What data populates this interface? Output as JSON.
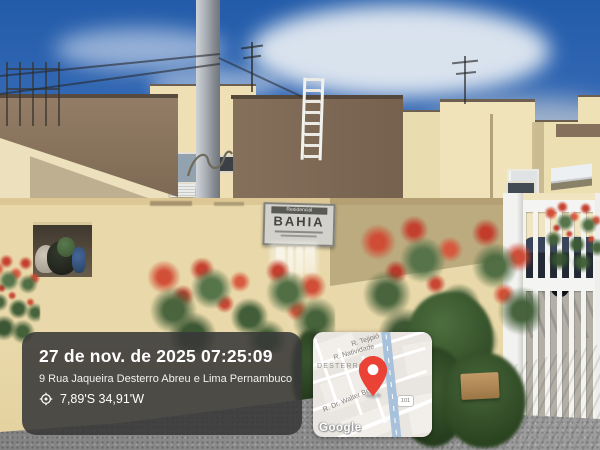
{
  "photo_overlay": {
    "timestamp": "27 de nov. de 2025 07:25:09",
    "address": "9 Rua Jaqueira Desterro Abreu e Lima Pernambuco",
    "coordinates": "7,89'S 34,91'W",
    "location_icon": "target-circle-icon",
    "panel_color": "#3a3a3a"
  },
  "map_card": {
    "streets": {
      "top": "R. Tejipió",
      "second": "R. Natividade",
      "bottom": "R. Dr. Walter Belian"
    },
    "district": "DESTERRO",
    "route_shield": "101",
    "attribution": "Google",
    "pin_color": "#EA4335"
  },
  "building_sign": {
    "header": "Residencial",
    "name": "BAHIA"
  },
  "scene_colors": {
    "sky": "#3567b2",
    "building_cream": "#efe0b6",
    "building_brown": "#7f6a55",
    "wall_cream": "#e9d8a9",
    "gate_white": "#f2f2f0",
    "flower_red": "#c84334",
    "car_dark": "#222935"
  }
}
